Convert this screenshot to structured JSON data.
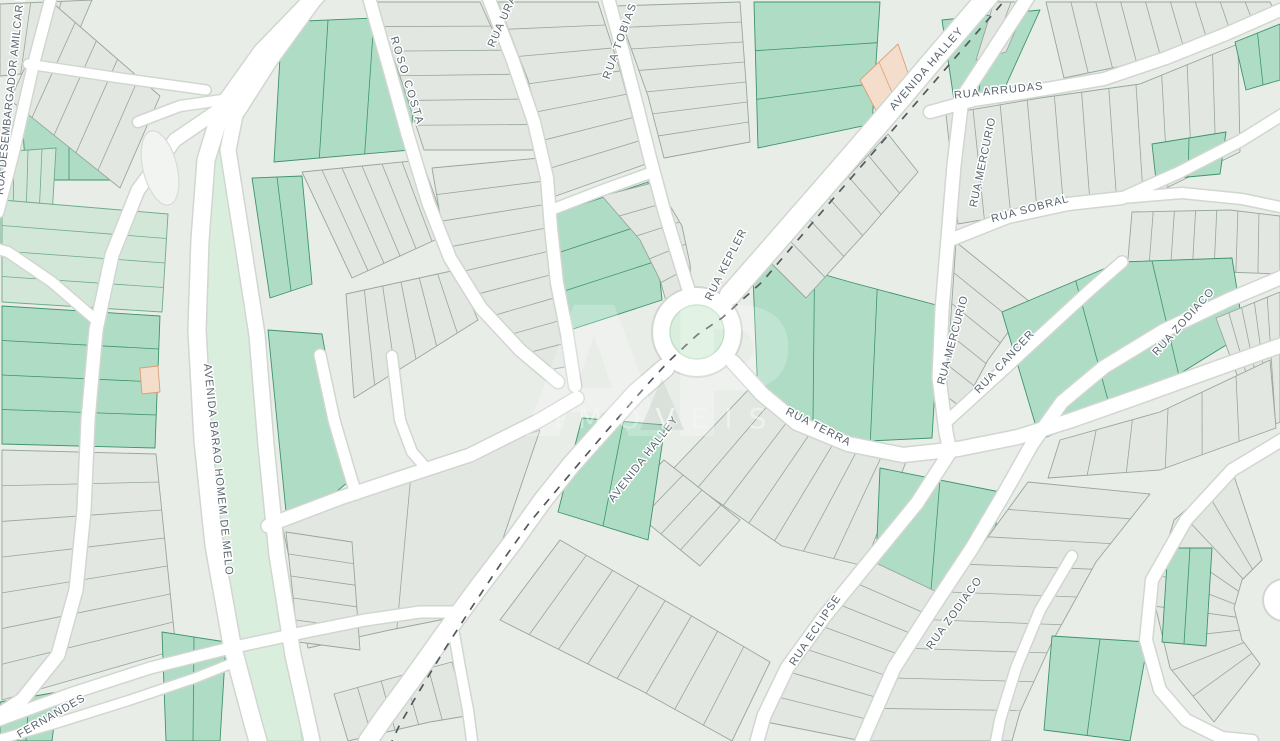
{
  "map": {
    "type": "street-map",
    "watermark": {
      "logo": "AP",
      "word": "IMÓVEIS"
    },
    "street_labels": [
      {
        "id": "rua-desembargador-amilcar",
        "label": "RUA DESEMBARGADOR AMILCAR DE"
      },
      {
        "id": "roso-costa",
        "label": "ROSO COSTA"
      },
      {
        "id": "rua-urano",
        "label": "RUA URANO"
      },
      {
        "id": "rua-tobias",
        "label": "RUA TOBIAS"
      },
      {
        "id": "avenida-halley-ne",
        "label": "AVENIDA HALLEY"
      },
      {
        "id": "rua-arrudas",
        "label": "RUA ARRUDAS"
      },
      {
        "id": "rua-mercurio-north",
        "label": "RUA MERCURIO"
      },
      {
        "id": "rua-sobral",
        "label": "RUA SOBRAL"
      },
      {
        "id": "rua-kepler",
        "label": "RUA KEPLER"
      },
      {
        "id": "rua-mercurio-south",
        "label": "RUA MERCURIO"
      },
      {
        "id": "rua-cancer",
        "label": "RUA CANCER"
      },
      {
        "id": "rua-zodiaco-ne",
        "label": "RUA ZODIACO"
      },
      {
        "id": "rua-terra",
        "label": "RUA TERRA"
      },
      {
        "id": "avenida-halley-sw",
        "label": "AVENIDA HALLEY"
      },
      {
        "id": "rua-eclipse",
        "label": "RUA ECLIPSE"
      },
      {
        "id": "rua-zodiaco-south",
        "label": "RUA ZODIACO"
      },
      {
        "id": "avenida-barao-homem-de-melo",
        "label": "AVENIDA BARAO HOMEM DE MELO"
      },
      {
        "id": "fernandes",
        "label": "FERNANDES"
      }
    ],
    "colors": {
      "background": "#e9ede8",
      "parcel_gray": "#e2e7e1",
      "parcel_light_green": "#d3e7d9",
      "parcel_green": "#aedcc5",
      "parcel_peach": "#f4ddca",
      "median_green": "#daeedd",
      "road_fill": "#ffffff",
      "road_casing": "#d1d6d0",
      "boundary_dash": "#54595d",
      "label_text": "#58646e"
    }
  }
}
